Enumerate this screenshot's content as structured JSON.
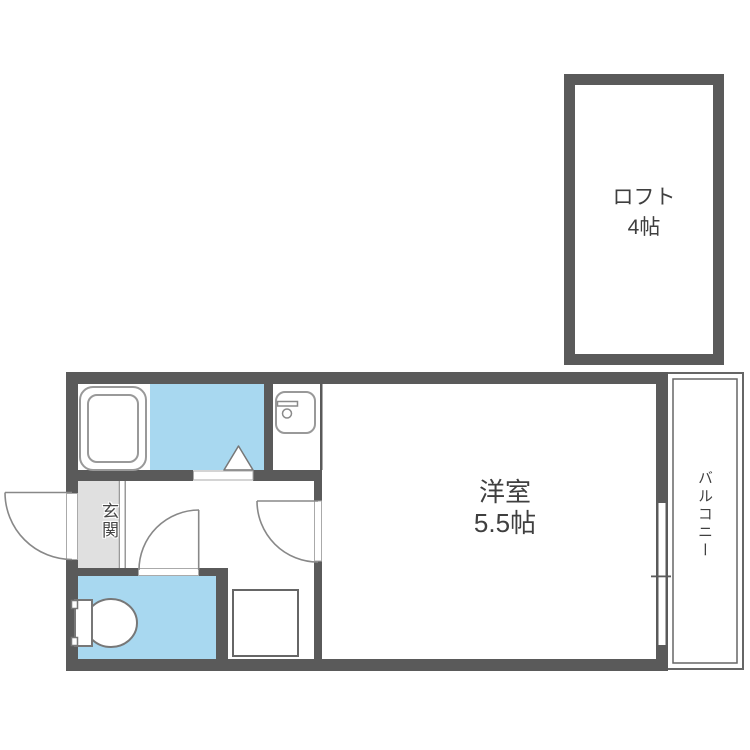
{
  "colors": {
    "wall": "#5a5a5a",
    "water": "#a8d8f0",
    "genkan": "#e0e0e0",
    "fixture": "#999999",
    "door": "#888888",
    "rail": "#666666",
    "text": "#3f3f3f"
  },
  "rooms": {
    "loft": {
      "name": "ロフト",
      "size": "4帖"
    },
    "main_room": {
      "name": "洋室",
      "size": "5.5帖"
    },
    "balcony": {
      "name": "バルコニー"
    },
    "entrance": {
      "name": "玄関"
    }
  },
  "fixtures": [
    "bathtub",
    "bath-door-triangle",
    "kitchen-sink",
    "toilet",
    "storage-square",
    "entrance-door",
    "toilet-door",
    "main-room-door",
    "balcony-sliding-window"
  ]
}
